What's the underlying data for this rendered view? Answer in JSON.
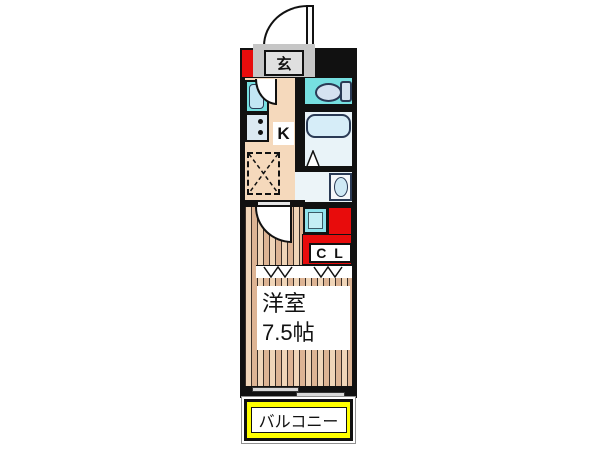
{
  "floorplan": {
    "labels": {
      "entrance": "玄",
      "kitchen": "K",
      "closet": "C L",
      "room_name": "洋室",
      "room_size": "7.5帖",
      "balcony": "バルコニー"
    },
    "rooms": [
      {
        "name": "entrance-genkan",
        "label": "玄"
      },
      {
        "name": "kitchen",
        "label": "K"
      },
      {
        "name": "toilet-room",
        "label": ""
      },
      {
        "name": "bathroom",
        "label": ""
      },
      {
        "name": "washroom",
        "label": ""
      },
      {
        "name": "closet",
        "label": "C L"
      },
      {
        "name": "western-room",
        "label": "洋室 7.5帖"
      },
      {
        "name": "balcony",
        "label": "バルコニー"
      }
    ],
    "colors": {
      "wall": "#111111",
      "accent_red": "#e80c0c",
      "balcony_yellow": "#ffff00",
      "water_cyan": "#76dfe0",
      "fixture_blue": "#d5e2f0",
      "bath_bg": "#e9f3f8",
      "tub_fill": "#d6edf8",
      "kitchen_floor": "#f5d9bc",
      "plank_light": "#f0d5b8",
      "plank_dark": "#ddb494",
      "washer_cyan": "#8fe2ec",
      "entry_gray": "#c6c6c6"
    }
  }
}
